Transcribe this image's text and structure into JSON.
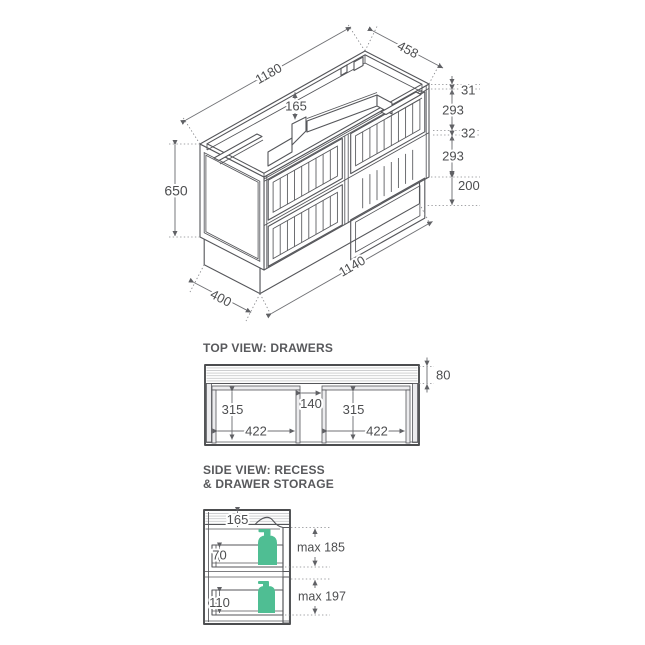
{
  "colors": {
    "line": "#55565A",
    "dim_line": "#707175",
    "text": "#4D4E50",
    "accent_green": "#4FBE93",
    "hatch": "#C9CACC"
  },
  "iso_view": {
    "dims": {
      "top_width": "1180",
      "top_depth": "458",
      "recess_depth": "165",
      "top_rail": "31",
      "top_drawer": "293",
      "mid_rail": "32",
      "bottom_drawer": "293",
      "kick_height": "200",
      "cabinet_height": "650",
      "kick_depth": "400",
      "kick_width": "1140"
    }
  },
  "top_view": {
    "title": "TOP VIEW: DRAWERS",
    "dims": {
      "back_recess": "80",
      "left_drawer_depth": "315",
      "center_gap": "140",
      "right_drawer_depth": "315",
      "left_drawer_width": "422",
      "right_drawer_width": "422"
    }
  },
  "side_view": {
    "title_line_1": "SIDE VIEW: RECESS",
    "title_line_2": "& DRAWER STORAGE",
    "dims": {
      "recess_depth": "165",
      "top_drawer_inner": "70",
      "bottom_drawer_inner": "110",
      "top_clearance": "max 185",
      "bottom_clearance": "max 197"
    }
  }
}
